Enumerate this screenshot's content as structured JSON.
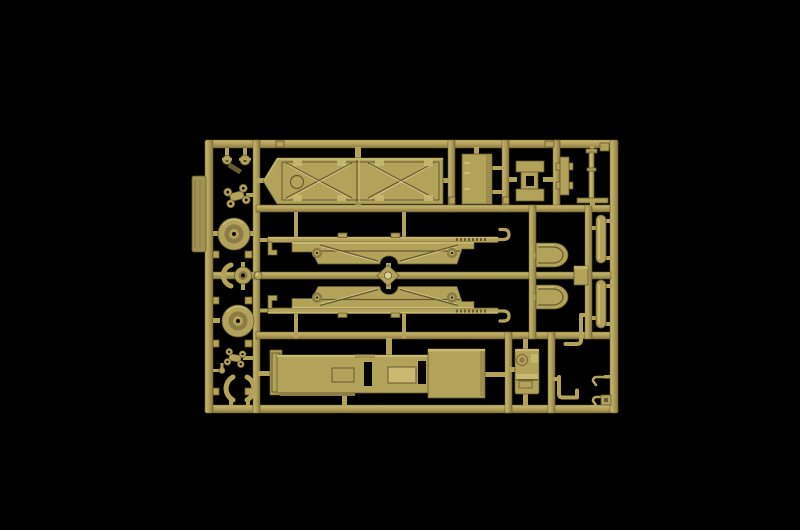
{
  "scene": {
    "type": "product-photograph",
    "subject": "injection-molded plastic model kit sprue",
    "description": "Tan / sand colored model kit sprue (parts frame) with trailer chassis parts, photographed on a black background",
    "background": "black",
    "text_visible": "none"
  },
  "colors": {
    "bg": "#000000",
    "plastic-base": "#b3a35a",
    "plastic-light": "#c9ba72",
    "plastic-lighter": "#ddd094",
    "plastic-dark": "#8b7b44",
    "plastic-shadow": "#665a30",
    "plastic-deep": "#3f3720",
    "hole": "#070602",
    "tag": "#a29252"
  },
  "parts_inventory": [
    {
      "id": "deck-platform",
      "label": "flat deck platform with X cross-bracing",
      "qty": 1
    },
    {
      "id": "bed-floor",
      "label": "trailer bed floor with rectangular cutouts",
      "qty": 1
    },
    {
      "id": "chassis-rail",
      "label": "long chassis side rail with tow hook",
      "qty": 2
    },
    {
      "id": "road-wheel",
      "label": "round wheel / pulley with hub hole",
      "qty": 2
    },
    {
      "id": "fender",
      "label": "rounded fender",
      "qty": 2
    },
    {
      "id": "cylinder",
      "label": "cylindrical tank / roller",
      "qty": 2
    },
    {
      "id": "toolbox",
      "label": "stowage box with round filler cap",
      "qty": 1
    },
    {
      "id": "jack-rod",
      "label": "long jack stand rod with T-foot",
      "qty": 1
    },
    {
      "id": "cross-fitting",
      "label": "cross-shaped fitting with square hole",
      "qty": 1
    },
    {
      "id": "i-beam-bracket",
      "label": "narrow I-beam bracket",
      "qty": 1
    },
    {
      "id": "equipment-box",
      "label": "small rectangular box",
      "qty": 1
    },
    {
      "id": "x-bracket",
      "label": "four-pad X bracket",
      "qty": 2
    },
    {
      "id": "crescent-clamp",
      "label": "C-shaped crescent clamp",
      "qty": 4
    },
    {
      "id": "hub-fitting",
      "label": "small hub with crescent",
      "qty": 1
    },
    {
      "id": "spool-fitting",
      "label": "tiny spool / valve fitting",
      "qty": 2
    },
    {
      "id": "bent-rod",
      "label": "L-bent rod",
      "qty": 2
    },
    {
      "id": "tow-hook-small",
      "label": "small hook",
      "qty": 2
    },
    {
      "id": "axle-runner",
      "label": "central axle runner with ball joint",
      "qty": 1
    },
    {
      "id": "molding-tab",
      "label": "flat molding tab on left frame edge",
      "qty": 1
    }
  ]
}
